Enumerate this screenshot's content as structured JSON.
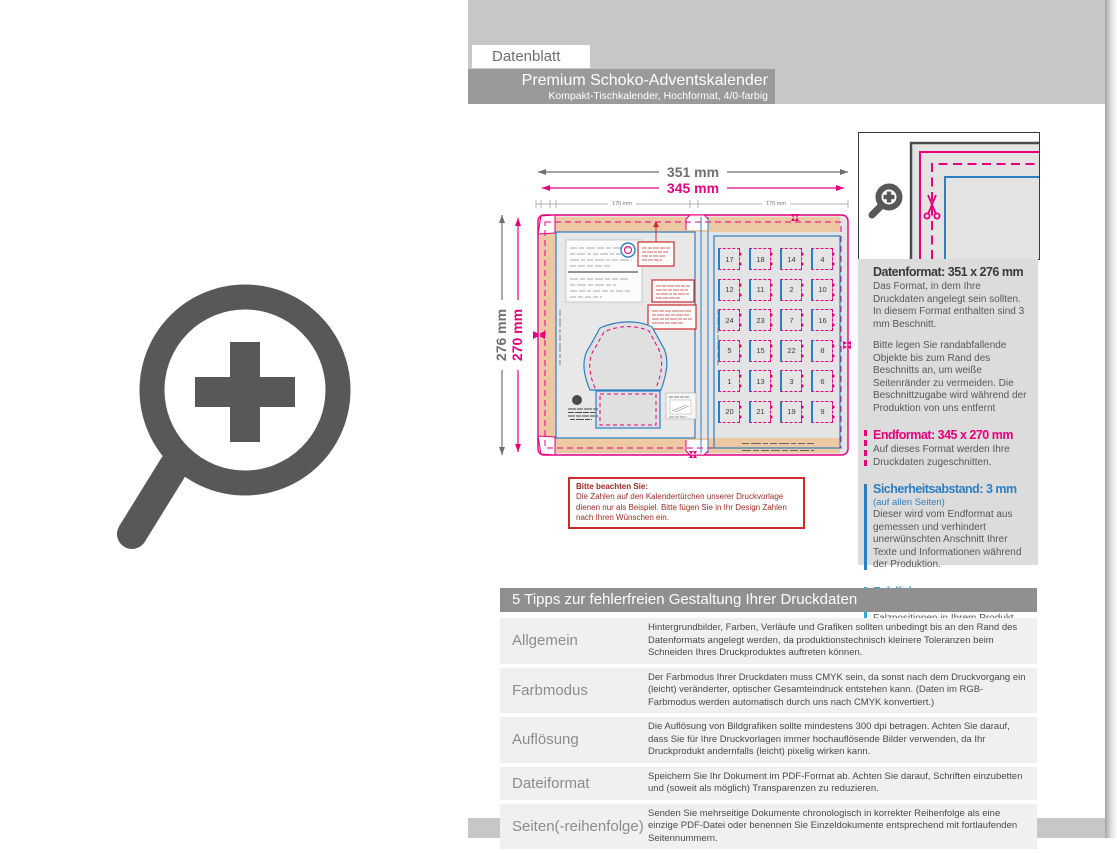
{
  "header": {
    "label": "Datenblatt",
    "title": "Premium Schoko-Adventskalender",
    "subtitle": "Kompakt-Tischkalender, Hochformat, 4/0-farbig"
  },
  "diagram": {
    "dim_width_outer": "351 mm",
    "dim_width_final": "345 mm",
    "dim_height_outer": "276 mm",
    "dim_height_final": "270 mm",
    "dim_panel_left": "170 mm",
    "dim_panel_right": "170 mm",
    "door_numbers": [
      [
        17,
        18,
        14,
        4
      ],
      [
        12,
        11,
        2,
        10
      ],
      [
        24,
        23,
        7,
        16
      ],
      [
        5,
        15,
        22,
        8
      ],
      [
        1,
        13,
        3,
        6
      ],
      [
        20,
        21,
        19,
        9
      ]
    ],
    "note": {
      "title": "Bitte beachten Sie:",
      "body": "Die Zahlen auf den Kalendertürchen unserer Druckvorlage dienen nur als Beispiel. Bitte fügen Sie in Ihr Design Zahlen nach Ihren Wünschen ein."
    }
  },
  "info_panel": {
    "datenformat": {
      "heading": "Datenformat: 351 x 276 mm",
      "body1": "Das Format, in dem Ihre Druckdaten angelegt sein sollten. In diesem Format enthalten sind 3 mm Beschnitt.",
      "body2": "Bitte legen Sie randabfallende Objekte bis zum Rand des Beschnitts an, um weiße Seitenränder zu vermeiden. Die Beschnittzugabe wird während der Produktion von uns entfernt"
    },
    "endformat": {
      "heading": "Endformat: 345 x 270 mm",
      "body": "Auf dieses Format werden Ihre Druckdaten zugeschnitten."
    },
    "sicherheitsabstand": {
      "heading": "Sicherheitsabstand: 3 mm",
      "subheading": "(auf allen Seiten)",
      "body": "Dieser wird vom Endformat aus gemessen und verhindert unerwünschten Anschnitt Ihrer Texte und Informationen während der Produktion."
    },
    "falzlinien": {
      "heading": "Falzlinien",
      "body": "Hier befinden sich die Falzpositionen in Ihrem Produkt."
    }
  },
  "tips": {
    "header": "5 Tipps zur fehlerfreien Gestaltung Ihrer Druckdaten",
    "rows": [
      {
        "label": "Allgemein",
        "text": "Hintergrundbilder, Farben, Verläufe und Grafiken sollten unbedingt bis an den Rand des Datenformats angelegt werden, da produktionstechnisch kleinere Toleranzen beim Schneiden Ihres Druckproduktes auftreten können."
      },
      {
        "label": "Farbmodus",
        "text": "Der Farbmodus Ihrer Druckdaten muss CMYK sein, da sonst nach dem Druckvorgang ein (leicht) veränderter, optischer Gesamteindruck entstehen kann. (Daten im RGB-Farbmodus werden automatisch durch uns nach CMYK konvertiert.)"
      },
      {
        "label": "Auflösung",
        "text": "Die Auflösung von Bildgrafiken sollte mindestens 300 dpi betragen. Achten Sie darauf, dass Sie für Ihre Druckvorlagen immer hochauflösende Bilder verwenden, da Ihr Druckprodukt andernfalls (leicht) pixelig wirken kann."
      },
      {
        "label": "Dateiformat",
        "text": "Speichern Sie Ihr Dokument im PDF-Format ab. Achten Sie darauf, Schriften einzubetten und (soweit als möglich) Transparenzen zu reduzieren."
      },
      {
        "label": "Seiten(-reihenfolge)",
        "text": "Senden Sie mehrseitige Dokumente chronologisch in korrekter Reihenfolge als eine einzige PDF-Datei oder benennen Sie Einzeldokumente entsprechend mit fortlaufenden Seitennummern."
      }
    ]
  },
  "colors": {
    "magenta": "#e6007e",
    "blue": "#2e7fc0",
    "cyan": "#29abe2",
    "band_gray": "#c7c7c7",
    "title_gray": "#9a9a9a",
    "icon_gray": "#58585a",
    "note_red": "#cc2b2b",
    "flap_beige": "#ecc9a3"
  }
}
